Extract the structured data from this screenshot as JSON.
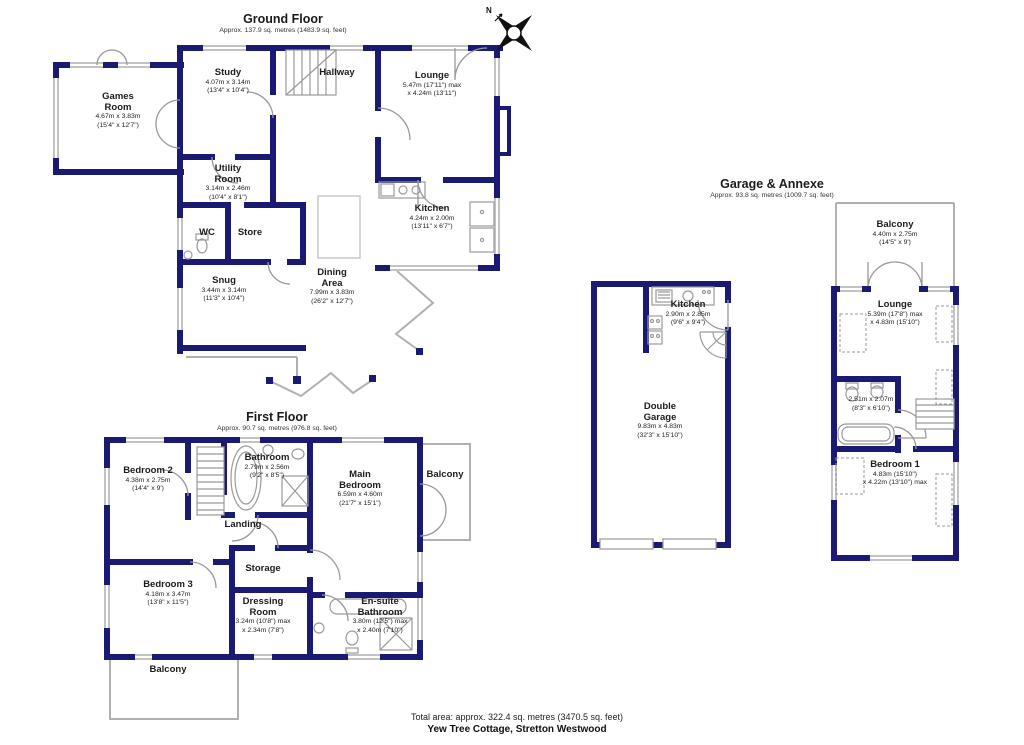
{
  "property": {
    "footer_line1": "Total area: approx. 322.4 sq. metres (3470.5 sq. feet)",
    "footer_line2": "Yew Tree Cottage, Stretton Westwood"
  },
  "compass": {
    "label": "N"
  },
  "colors": {
    "wall": "#1a1a73",
    "window": "#c3c3c3",
    "fixture": "#9a9a9a",
    "open_line": "#b0b0b0"
  },
  "ground": {
    "title": "Ground Floor",
    "subtitle": "Approx. 137.9 sq. metres (1483.9 sq. feet)",
    "rooms": [
      {
        "name": "Games\nRoom",
        "dim_m": "4.67m x 3.83m",
        "dim_ft": "(15'4\" x 12'7\")"
      },
      {
        "name": "Study",
        "dim_m": "4.07m x 3.14m",
        "dim_ft": "(13'4\" x 10'4\")"
      },
      {
        "name": "Hallway",
        "dim_m": "",
        "dim_ft": ""
      },
      {
        "name": "Lounge",
        "dim_m": "5.47m (17'11\") max",
        "dim_ft": "x 4.24m (13'11\")"
      },
      {
        "name": "Utility\nRoom",
        "dim_m": "3.14m x 2.46m",
        "dim_ft": "(10'4\" x 8'1\")"
      },
      {
        "name": "WC",
        "dim_m": "",
        "dim_ft": ""
      },
      {
        "name": "Store",
        "dim_m": "",
        "dim_ft": ""
      },
      {
        "name": "Snug",
        "dim_m": "3.44m x 3.14m",
        "dim_ft": "(11'3\" x 10'4\")"
      },
      {
        "name": "Dining\nArea",
        "dim_m": "7.99m x 3.83m",
        "dim_ft": "(26'2\" x 12'7\")"
      },
      {
        "name": "Kitchen",
        "dim_m": "4.24m x 2.00m",
        "dim_ft": "(13'11\" x 6'7\")"
      }
    ]
  },
  "first": {
    "title": "First Floor",
    "subtitle": "Approx. 90.7 sq. metres (976.8 sq. feet)",
    "rooms": [
      {
        "name": "Bedroom 2",
        "dim_m": "4.38m x 2.75m",
        "dim_ft": "(14'4\" x 9')"
      },
      {
        "name": "Bathroom",
        "dim_m": "2.79m x 2.56m",
        "dim_ft": "(9'2\" x 8'5\")"
      },
      {
        "name": "Main\nBedroom",
        "dim_m": "6.59m x 4.60m",
        "dim_ft": "(21'7\" x 15'1\")"
      },
      {
        "name": "Balcony",
        "dim_m": "",
        "dim_ft": ""
      },
      {
        "name": "Landing",
        "dim_m": "",
        "dim_ft": ""
      },
      {
        "name": "Bedroom 3",
        "dim_m": "4.18m x 3.47m",
        "dim_ft": "(13'8\" x 11'5\")"
      },
      {
        "name": "Storage",
        "dim_m": "",
        "dim_ft": ""
      },
      {
        "name": "Dressing\nRoom",
        "dim_m": "3.24m (10'8\") max",
        "dim_ft": "x 2.34m (7'8\")"
      },
      {
        "name": "En-suite\nBathroom",
        "dim_m": "3.80m (12'5\") max",
        "dim_ft": "x 2.40m (7'10\")"
      },
      {
        "name": "Balcony",
        "dim_m": "",
        "dim_ft": ""
      }
    ]
  },
  "garage": {
    "title": "Garage & Annexe",
    "subtitle": "Approx. 93.8 sq. metres (1009.7 sq. feet)",
    "rooms": [
      {
        "name": "Balcony",
        "dim_m": "4.40m x 2.75m",
        "dim_ft": "(14'5\" x 9')"
      },
      {
        "name": "Kitchen",
        "dim_m": "2.90m x 2.85m",
        "dim_ft": "(9'6\" x 9'4\")"
      },
      {
        "name": "Double\nGarage",
        "dim_m": "9.83m x 4.83m",
        "dim_ft": "(32'3\" x 15'10\")"
      },
      {
        "name": "Lounge",
        "dim_m": "5.39m (17'8\") max",
        "dim_ft": "x 4.83m (15'10\")"
      },
      {
        "name": "",
        "dim_m": "2.51m x 2.07m",
        "dim_ft": "(8'3\" x 6'10\")"
      },
      {
        "name": "Bedroom 1",
        "dim_m": "4.83m (15'10\")",
        "dim_ft": "x 4.22m (13'10\") max"
      }
    ]
  }
}
